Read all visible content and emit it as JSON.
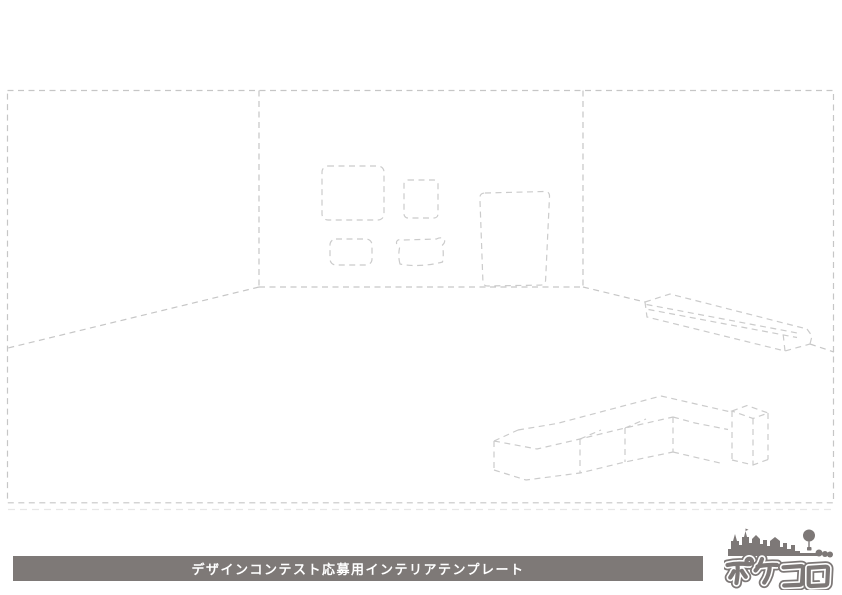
{
  "banner": {
    "label": "デザインコンテスト応募用インテリアテンプレート"
  },
  "logo": {
    "name": "ポケコロ"
  },
  "drawing": {
    "elements": [
      "room-outline",
      "back-wall",
      "left-wall-floor-line",
      "right-wall-floor-line",
      "wall-frame-large",
      "wall-frame-square",
      "wall-frame-small",
      "wall-frame-ornate",
      "wall-door",
      "wall-shelf",
      "l-shaped-sofa",
      "sofa-armrest-box",
      "floor-shadow-line"
    ]
  },
  "colors": {
    "background": "#ffffff",
    "line": "#c6c6c6",
    "line_soft": "#cbcbcb",
    "line_faint": "#e7e7e7",
    "banner_bg": "#7e7977",
    "banner_text": "#ffffff",
    "logo": "#7d7877"
  }
}
